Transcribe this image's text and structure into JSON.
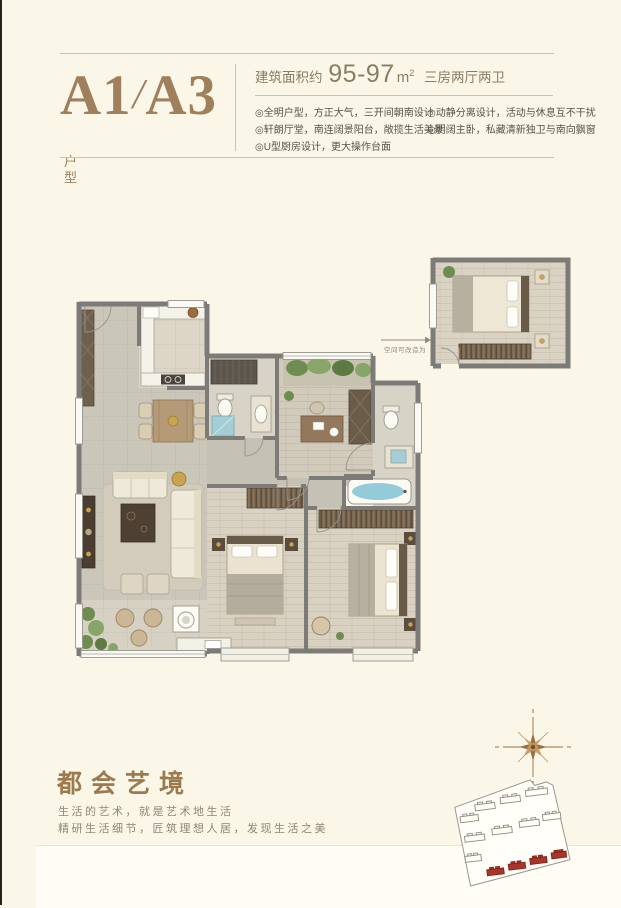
{
  "header": {
    "unit_code_part1": "A1",
    "unit_code_separator": "/",
    "unit_code_part2": "A3",
    "unit_type_suffix": "户型",
    "area_label": "建筑面积约",
    "area_value": "95-97",
    "area_unit_base": "m",
    "area_unit_sup": "2",
    "layout_summary": "三房两厅两卫",
    "features_left": [
      "◎全明户型，方正大气，三开间朝南设计",
      "◎轩朗厅堂，南连阔景阳台，敞揽生活美景",
      "◎U型厨房设计，更大操作台面"
    ],
    "features_right": [
      "◎动静分离设计，活动与休息互不干扰",
      "◎明阔主卧，私藏清新独卫与南向飘窗"
    ]
  },
  "floorplan": {
    "conversion_note": "空间可改造为"
  },
  "footer": {
    "title": "都会艺境",
    "slogan_line1": "生活的艺术，就是艺术地生活",
    "slogan_line2": "精研生活细节，匠筑理想人居，发现生活之美"
  },
  "colors": {
    "background": "#fbf7e8",
    "accent_brown": "#a0805c",
    "text_gray": "#55524a",
    "wall_gray": "#7c7b77",
    "water_blue": "#9ed3dc",
    "plant_green": "#6d8c50",
    "highlight_red": "#a8352a",
    "compass_gold": "#99713f"
  }
}
